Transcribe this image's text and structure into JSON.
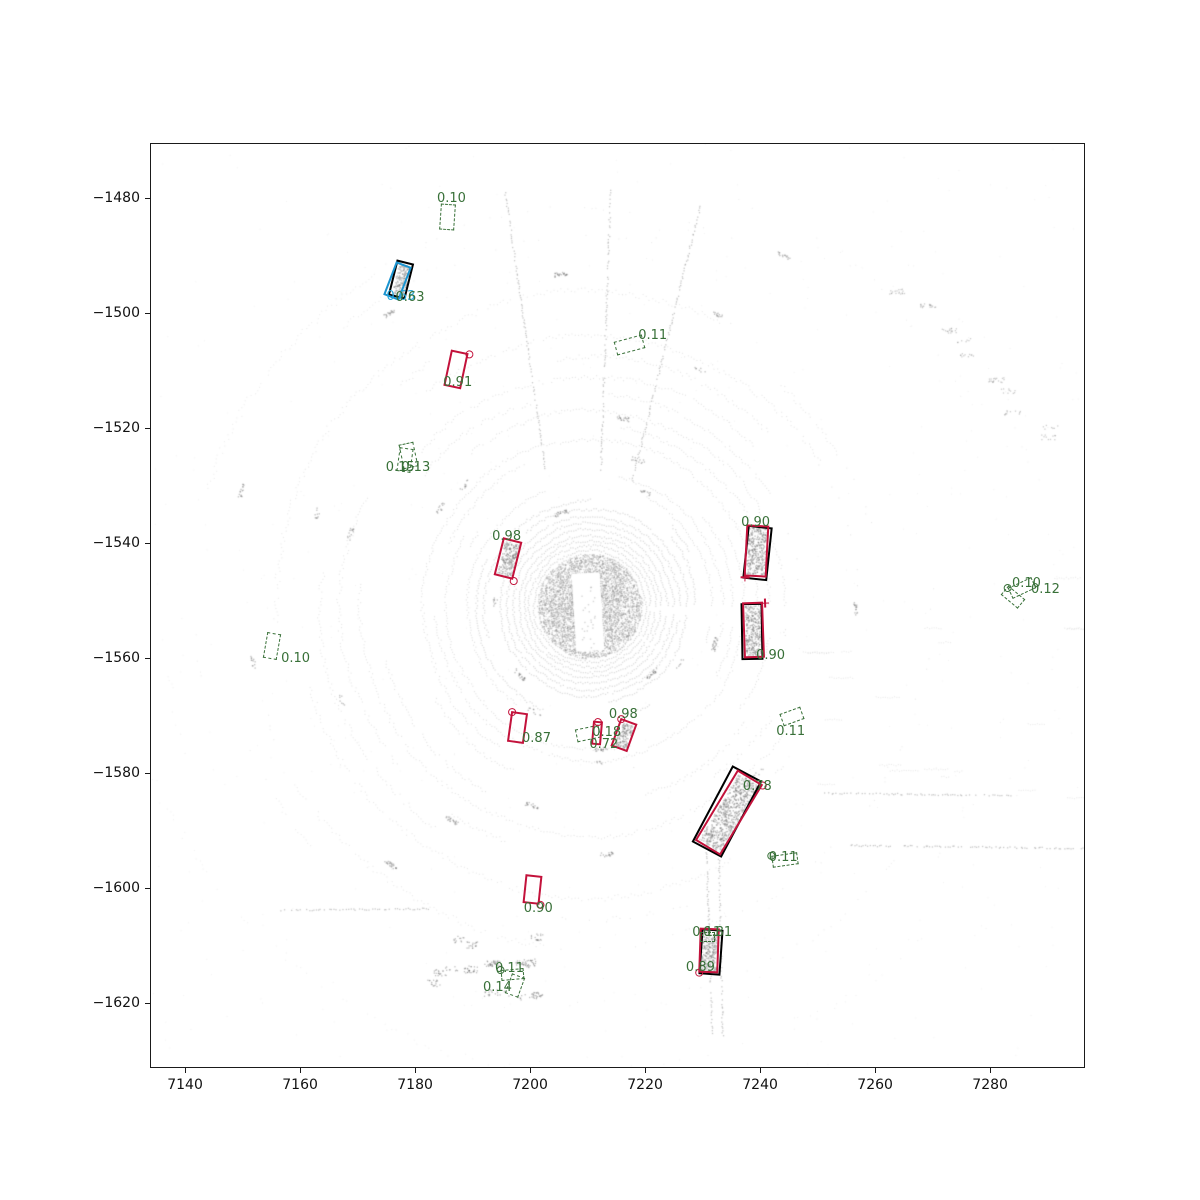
{
  "figure": {
    "title": "",
    "background": "#ffffff"
  },
  "chart_data": {
    "type": "scatter",
    "title": "",
    "xlabel": "",
    "ylabel": "",
    "xlim": [
      7133.9,
      7296.5
    ],
    "ylim": [
      -1631.3,
      -1470.4
    ],
    "grid": false,
    "legend": null,
    "xticks": {
      "values": [
        7140,
        7160,
        7180,
        7200,
        7220,
        7240,
        7260,
        7280
      ],
      "labels": [
        "7140",
        "7160",
        "7180",
        "7200",
        "7220",
        "7240",
        "7260",
        "7280"
      ]
    },
    "yticks": {
      "values": [
        -1480,
        -1500,
        -1520,
        -1540,
        -1560,
        -1580,
        -1600,
        -1620
      ],
      "labels": [
        "−1480",
        "−1500",
        "−1520",
        "−1540",
        "−1560",
        "−1580",
        "−1600",
        "−1620"
      ]
    },
    "colors": {
      "pred": "#c3123b",
      "low": "#387038",
      "gt": "#000000",
      "special": "#1a93cf",
      "label_green": "#387038",
      "label_cyan": "#29a8dc",
      "points": "#9a9a9a"
    },
    "point_cloud": {
      "description": "lidar bird's-eye-view sweep, concentric scan rings",
      "center": [
        7210.3,
        -1550.9
      ],
      "color": "#9a9a9a",
      "features": [
        {
          "type": "line",
          "from": [
            7250.4,
            -1583.4
          ],
          "to": [
            7283.5,
            -1583.8
          ]
        },
        {
          "type": "line",
          "from": [
            7255.6,
            -1592.5
          ],
          "to": [
            7296.0,
            -1593.0
          ]
        },
        {
          "type": "line",
          "from": [
            7230.6,
            -1593.7
          ],
          "to": [
            7231.6,
            -1625.5
          ]
        },
        {
          "type": "line",
          "from": [
            7232.7,
            -1593.7
          ],
          "to": [
            7233.4,
            -1625.5
          ]
        },
        {
          "type": "line",
          "from": [
            7195.6,
            -1478.9
          ],
          "to": [
            7202.6,
            -1527.3
          ]
        },
        {
          "type": "line",
          "from": [
            7213.9,
            -1478.6
          ],
          "to": [
            7212.2,
            -1527.3
          ]
        },
        {
          "type": "line",
          "from": [
            7217.7,
            -1529.0
          ],
          "to": [
            7229.5,
            -1481.2
          ]
        },
        {
          "type": "line",
          "from": [
            7156.5,
            -1603.8
          ],
          "to": [
            7182.6,
            -1603.5
          ]
        }
      ]
    },
    "boxes": [
      {
        "style": "low",
        "c": [
          7185.7,
          -1483.3
        ],
        "s": [
          2.6,
          4.6
        ],
        "rot": 4
      },
      {
        "style": "gt",
        "c": [
          7177.6,
          -1494.2
        ],
        "s": [
          3.1,
          6.4
        ],
        "rot": 14,
        "fill": true
      },
      {
        "style": "special",
        "c": [
          7176.9,
          -1494.4
        ],
        "s": [
          3.0,
          6.3
        ],
        "rot": 21
      },
      {
        "style": "pred",
        "c": [
          7187.1,
          -1509.7
        ],
        "s": [
          3.2,
          6.4
        ],
        "rot": 12,
        "marker": {
          "shape": "circle",
          "corner": "top-right"
        }
      },
      {
        "style": "low",
        "c": [
          7217.2,
          -1505.5
        ],
        "s": [
          5.0,
          2.4
        ],
        "rot": -15
      },
      {
        "style": "low",
        "c": [
          7178.8,
          -1524.7
        ],
        "s": [
          2.6,
          4.4
        ],
        "rot": -12
      },
      {
        "style": "low",
        "c": [
          7178.3,
          -1525.5
        ],
        "s": [
          2.4,
          4.2
        ],
        "rot": 8
      },
      {
        "style": "pred",
        "c": [
          7196.2,
          -1542.6
        ],
        "s": [
          3.5,
          6.8
        ],
        "rot": 14,
        "fill": true,
        "marker": {
          "shape": "circle",
          "corner": "bottom-right"
        }
      },
      {
        "style": "gt",
        "c": [
          7239.6,
          -1541.7
        ],
        "s": [
          4.3,
          9.4
        ],
        "rot": 6
      },
      {
        "style": "pred",
        "c": [
          7239.3,
          -1541.3
        ],
        "s": [
          4.0,
          9.0
        ],
        "rot": 3,
        "fill": true,
        "marker": {
          "shape": "plus",
          "corner": "bottom-left"
        }
      },
      {
        "style": "gt",
        "c": [
          7238.6,
          -1555.4
        ],
        "s": [
          3.8,
          9.9
        ],
        "rot": -1
      },
      {
        "style": "pred",
        "c": [
          7238.8,
          -1555.1
        ],
        "s": [
          3.7,
          9.7
        ],
        "rot": -2,
        "fill": true,
        "marker": {
          "shape": "plus",
          "corner": "top-right"
        }
      },
      {
        "style": "low",
        "c": [
          7285.6,
          -1547.8
        ],
        "s": [
          4.5,
          2.1
        ],
        "rot": -25,
        "marker": {
          "shape": "circle",
          "corner": "top-left"
        }
      },
      {
        "style": "low",
        "c": [
          7284.0,
          -1549.4
        ],
        "s": [
          3.8,
          2.1
        ],
        "rot": 40
      },
      {
        "style": "low",
        "c": [
          7155.1,
          -1557.9
        ],
        "s": [
          2.4,
          4.5
        ],
        "rot": 10
      },
      {
        "style": "pred",
        "c": [
          7197.9,
          -1572.0
        ],
        "s": [
          3.0,
          5.4
        ],
        "rot": 8,
        "marker": {
          "shape": "circle",
          "corner": "top-left"
        }
      },
      {
        "style": "low",
        "c": [
          7210.1,
          -1573.2
        ],
        "s": [
          4.2,
          2.3
        ],
        "rot": -12
      },
      {
        "style": "pred",
        "c": [
          7211.7,
          -1573.0
        ],
        "s": [
          1.7,
          4.2
        ],
        "rot": 5,
        "marker": {
          "shape": "circle",
          "corner": "top"
        }
      },
      {
        "style": "pred",
        "c": [
          7216.3,
          -1573.4
        ],
        "s": [
          3.1,
          5.2
        ],
        "rot": 20,
        "fill": true,
        "marker": {
          "shape": "circle",
          "corner": "top-left"
        }
      },
      {
        "style": "low",
        "c": [
          7245.6,
          -1570.2
        ],
        "s": [
          3.8,
          2.3
        ],
        "rot": -20
      },
      {
        "style": "gt",
        "c": [
          7234.3,
          -1586.6
        ],
        "s": [
          5.9,
          15.1
        ],
        "rot": 28
      },
      {
        "style": "pred",
        "c": [
          7234.6,
          -1586.9
        ],
        "s": [
          5.2,
          14.4
        ],
        "rot": 31,
        "fill": true,
        "marker": {
          "shape": "circle",
          "corner": "top-right"
        }
      },
      {
        "style": "low",
        "c": [
          7244.3,
          -1595.1
        ],
        "s": [
          4.5,
          2.1
        ],
        "rot": -8,
        "marker": {
          "shape": "circle",
          "corner": "top-left"
        }
      },
      {
        "style": "pred",
        "c": [
          7200.5,
          -1600.3
        ],
        "s": [
          3.0,
          5.0
        ],
        "rot": 6,
        "marker": {
          "shape": "circle",
          "corner": "bottom-right"
        }
      },
      {
        "style": "gt",
        "c": [
          7231.4,
          -1611.2
        ],
        "s": [
          3.8,
          8.0
        ],
        "rot": 4
      },
      {
        "style": "pred",
        "c": [
          7231.1,
          -1610.9
        ],
        "s": [
          3.5,
          7.8
        ],
        "rot": 2,
        "fill": true,
        "marker": {
          "shape": "circle",
          "corner": "bottom-left"
        }
      },
      {
        "style": "low",
        "c": [
          7230.8,
          -1608.5
        ],
        "s": [
          2.6,
          1.7
        ],
        "rot": 0
      },
      {
        "style": "low",
        "c": [
          7196.9,
          -1615.1
        ],
        "s": [
          4.0,
          1.9
        ],
        "rot": -5,
        "marker": {
          "shape": "circle",
          "corner": "top-left"
        }
      },
      {
        "style": "low",
        "c": [
          7197.4,
          -1617.0
        ],
        "s": [
          2.4,
          3.7
        ],
        "rot": 20
      }
    ],
    "labels": [
      {
        "text": "0.10",
        "pos": [
          7183.8,
          -1478.9
        ],
        "color": "green"
      },
      {
        "text": "0.63",
        "pos": [
          7175.0,
          -1496.0
        ],
        "color": "cyan"
      },
      {
        "text": "0.63",
        "pos": [
          7176.6,
          -1496.2
        ],
        "color": "green"
      },
      {
        "text": "0.91",
        "pos": [
          7184.9,
          -1510.9
        ],
        "color": "green"
      },
      {
        "text": "0.11",
        "pos": [
          7218.8,
          -1502.7
        ],
        "color": "green"
      },
      {
        "text": "0.15",
        "pos": [
          7174.9,
          -1525.7
        ],
        "color": "green"
      },
      {
        "text": "0.13",
        "pos": [
          7177.6,
          -1525.7
        ],
        "color": "green"
      },
      {
        "text": "0.98",
        "pos": [
          7193.4,
          -1537.7
        ],
        "color": "green"
      },
      {
        "text": "0.90",
        "pos": [
          7236.7,
          -1535.3
        ],
        "color": "green"
      },
      {
        "text": "0.90",
        "pos": [
          7239.3,
          -1558.4
        ],
        "color": "green"
      },
      {
        "text": "0.10",
        "pos": [
          7283.8,
          -1545.9
        ],
        "color": "green"
      },
      {
        "text": "0.12",
        "pos": [
          7287.1,
          -1546.9
        ],
        "color": "green"
      },
      {
        "text": "0.10",
        "pos": [
          7156.7,
          -1558.9
        ],
        "color": "green"
      },
      {
        "text": "0.87",
        "pos": [
          7198.6,
          -1572.8
        ],
        "color": "green"
      },
      {
        "text": "0.18",
        "pos": [
          7210.8,
          -1571.8
        ],
        "color": "green"
      },
      {
        "text": "0.72",
        "pos": [
          7210.3,
          -1573.9
        ],
        "color": "green"
      },
      {
        "text": "0.98",
        "pos": [
          7213.7,
          -1568.7
        ],
        "color": "green"
      },
      {
        "text": "0.11",
        "pos": [
          7242.8,
          -1571.6
        ],
        "color": "green"
      },
      {
        "text": "0.78",
        "pos": [
          7237.0,
          -1581.2
        ],
        "color": "green"
      },
      {
        "text": "0.11",
        "pos": [
          7241.5,
          -1593.5
        ],
        "color": "green"
      },
      {
        "text": "0.90",
        "pos": [
          7198.9,
          -1602.4
        ],
        "color": "green"
      },
      {
        "text": "0.11",
        "pos": [
          7228.2,
          -1606.6
        ],
        "color": "green"
      },
      {
        "text": "0.81",
        "pos": [
          7230.1,
          -1606.6
        ],
        "color": "green"
      },
      {
        "text": "0.89",
        "pos": [
          7227.1,
          -1612.7
        ],
        "color": "green"
      },
      {
        "text": "0.11",
        "pos": [
          7193.9,
          -1612.8
        ],
        "color": "green"
      },
      {
        "text": "0.14",
        "pos": [
          7191.8,
          -1616.1
        ],
        "color": "green"
      }
    ]
  }
}
